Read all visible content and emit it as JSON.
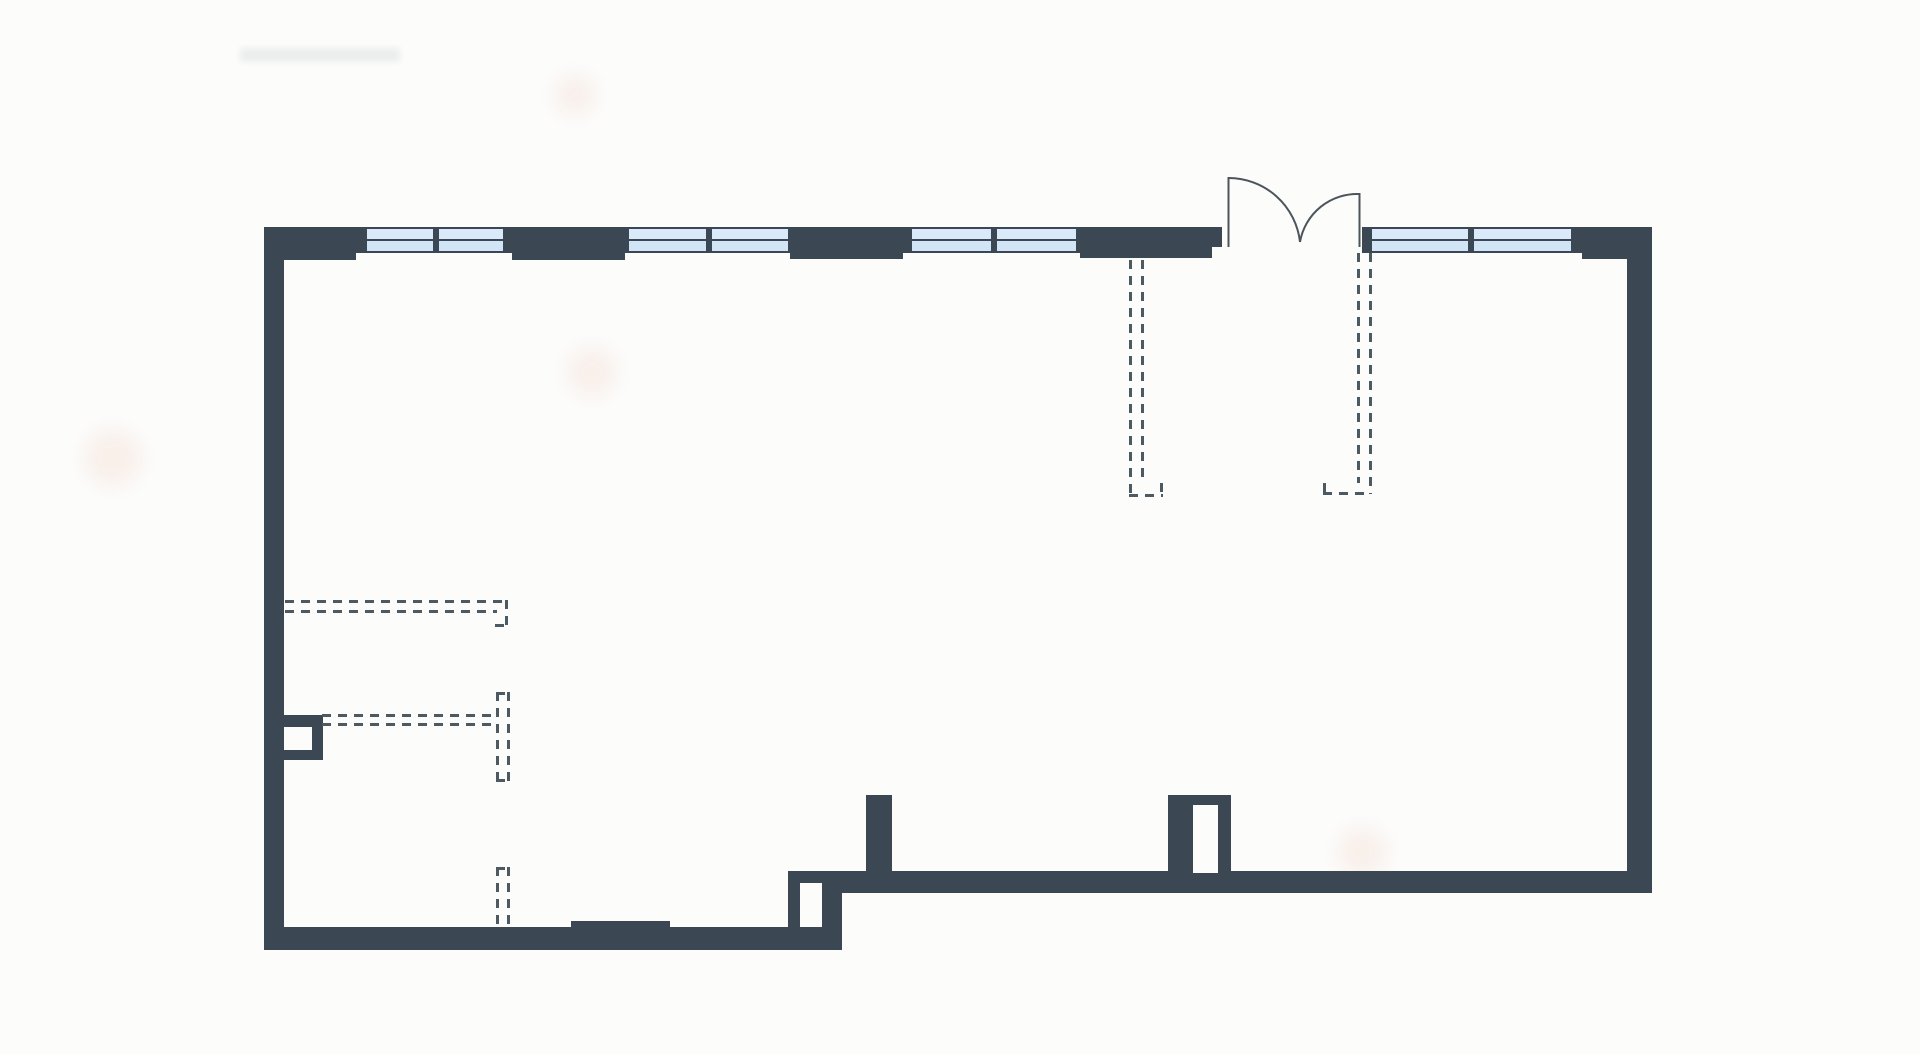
{
  "app": {
    "type": "architectural-floor-plan",
    "canvas": {
      "width": 1920,
      "height": 1054
    }
  },
  "colors": {
    "background": "#fcfcfb",
    "wall": "#3b4853",
    "dash": "#4e5a62",
    "window_pane_top": "#dbeafa",
    "window_pane_bottom": "#d2e5f6",
    "door_line": "#4d545b",
    "blob": "rgba(246,230,220,0.55)",
    "smudge": "#9aa0a4"
  },
  "plan": {
    "walls": [
      {
        "name": "top-corner-block-left",
        "x": 264,
        "y": 227,
        "w": 92,
        "h": 33
      },
      {
        "name": "top-wall-band-left-of-door",
        "x": 356,
        "y": 227,
        "w": 856,
        "h": 26
      },
      {
        "name": "top-wall-band-right-of-door",
        "x": 1362,
        "y": 227,
        "w": 290,
        "h": 26
      },
      {
        "name": "top-wall-block-b",
        "x": 512,
        "y": 227,
        "w": 113,
        "h": 33
      },
      {
        "name": "top-wall-block-c",
        "x": 790,
        "y": 227,
        "w": 113,
        "h": 32
      },
      {
        "name": "top-wall-block-d",
        "x": 1080,
        "y": 227,
        "w": 132,
        "h": 31
      },
      {
        "name": "door-jamb-left",
        "x": 1212,
        "y": 227,
        "w": 10,
        "h": 20
      },
      {
        "name": "door-jamb-right",
        "x": 1362,
        "y": 227,
        "w": 10,
        "h": 23
      },
      {
        "name": "top-corner-block-right",
        "x": 1573,
        "y": 227,
        "w": 79,
        "h": 25
      },
      {
        "name": "top-corner-right-ledge",
        "x": 1582,
        "y": 252,
        "w": 45,
        "h": 7
      },
      {
        "name": "left-wall",
        "x": 264,
        "y": 227,
        "w": 20,
        "h": 723
      },
      {
        "name": "right-wall",
        "x": 1627,
        "y": 227,
        "w": 25,
        "h": 666
      },
      {
        "name": "bottom-wall-lower",
        "x": 264,
        "y": 927,
        "w": 578,
        "h": 23
      },
      {
        "name": "bottom-wall-upper",
        "x": 788,
        "y": 871,
        "w": 864,
        "h": 22
      },
      {
        "name": "bottom-wall-step-connector",
        "x": 788,
        "y": 871,
        "w": 54,
        "h": 79
      },
      {
        "name": "bottom-wall-sill-strip",
        "x": 571,
        "y": 921,
        "w": 99,
        "h": 7
      },
      {
        "name": "interior-wall-stub",
        "x": 866,
        "y": 795,
        "w": 26,
        "h": 78
      },
      {
        "name": "interior-doorframe-stub",
        "x": 1168,
        "y": 795,
        "w": 63,
        "h": 78
      },
      {
        "name": "left-wall-column-box",
        "x": 284,
        "y": 715,
        "w": 39,
        "h": 45
      }
    ],
    "openings": [
      {
        "name": "step-wall-door-opening",
        "x": 800,
        "y": 883,
        "w": 22,
        "h": 44
      },
      {
        "name": "doorframe-stub-opening",
        "x": 1193,
        "y": 805,
        "w": 25,
        "h": 68
      },
      {
        "name": "column-box-opening",
        "x": 284,
        "y": 727,
        "w": 28,
        "h": 23
      }
    ],
    "windows": [
      {
        "name": "window-a1",
        "x": 365,
        "y": 227,
        "w": 70,
        "h": 26
      },
      {
        "name": "window-a2",
        "x": 437,
        "y": 227,
        "w": 68,
        "h": 26
      },
      {
        "name": "window-b1",
        "x": 627,
        "y": 227,
        "w": 81,
        "h": 26
      },
      {
        "name": "window-b2",
        "x": 710,
        "y": 227,
        "w": 80,
        "h": 26
      },
      {
        "name": "window-c1",
        "x": 910,
        "y": 227,
        "w": 83,
        "h": 26
      },
      {
        "name": "window-c2",
        "x": 995,
        "y": 227,
        "w": 83,
        "h": 26
      },
      {
        "name": "window-d1",
        "x": 1370,
        "y": 227,
        "w": 100,
        "h": 26
      },
      {
        "name": "window-d2",
        "x": 1472,
        "y": 227,
        "w": 101,
        "h": 26
      }
    ],
    "partition_dashes": [
      {
        "name": "closet-dash-left-a",
        "dir": "v",
        "x": 1129,
        "y": 260,
        "len": 237
      },
      {
        "name": "closet-dash-left-b",
        "dir": "v",
        "x": 1141,
        "y": 260,
        "len": 223
      },
      {
        "name": "closet-dash-left-foot",
        "dir": "h",
        "x": 1129,
        "y": 494,
        "len": 34
      },
      {
        "name": "closet-dash-left-tick",
        "dir": "v",
        "x": 1160,
        "y": 483,
        "len": 12
      },
      {
        "name": "closet-dash-right-a",
        "dir": "v",
        "x": 1357,
        "y": 253,
        "len": 230
      },
      {
        "name": "closet-dash-right-b",
        "dir": "v",
        "x": 1369,
        "y": 253,
        "len": 241
      },
      {
        "name": "closet-dash-right-foot",
        "dir": "h",
        "x": 1323,
        "y": 492,
        "len": 47
      },
      {
        "name": "closet-dash-right-tick",
        "dir": "v",
        "x": 1323,
        "y": 483,
        "len": 10
      },
      {
        "name": "partition-dash-h1-a",
        "dir": "h",
        "x": 285,
        "y": 600,
        "len": 223
      },
      {
        "name": "partition-dash-h1-b",
        "dir": "h",
        "x": 285,
        "y": 610,
        "len": 212
      },
      {
        "name": "partition-dash-h1-elbow",
        "dir": "v",
        "x": 505,
        "y": 600,
        "len": 27
      },
      {
        "name": "partition-dash-h1-tick",
        "dir": "h",
        "x": 495,
        "y": 624,
        "len": 11
      },
      {
        "name": "partition-dash-h2-a",
        "dir": "h",
        "x": 322,
        "y": 714,
        "len": 175
      },
      {
        "name": "partition-dash-h2-b",
        "dir": "h",
        "x": 322,
        "y": 723,
        "len": 175
      },
      {
        "name": "partition-dash-v1-a",
        "dir": "v",
        "x": 496,
        "y": 692,
        "len": 90
      },
      {
        "name": "partition-dash-v1-b",
        "dir": "v",
        "x": 507,
        "y": 692,
        "len": 90
      },
      {
        "name": "partition-dash-v1-cap-top",
        "dir": "h",
        "x": 496,
        "y": 692,
        "len": 14
      },
      {
        "name": "partition-dash-v1-cap-bot",
        "dir": "h",
        "x": 496,
        "y": 779,
        "len": 14
      },
      {
        "name": "partition-dash-v2-a",
        "dir": "v",
        "x": 496,
        "y": 867,
        "len": 60
      },
      {
        "name": "partition-dash-v2-b",
        "dir": "v",
        "x": 507,
        "y": 867,
        "len": 60
      },
      {
        "name": "partition-dash-v2-cap",
        "dir": "h",
        "x": 496,
        "y": 867,
        "len": 14
      }
    ],
    "door": {
      "paths": [
        {
          "name": "door-leaf-left-line",
          "d": "M 1228.5 177 L 1228.5 247"
        },
        {
          "name": "door-leaf-right-line",
          "d": "M 1359.5 193 L 1359.5 247"
        },
        {
          "name": "door-swing-arc-left",
          "d": "M 1228.5 178 A 72 72 0 0 1 1300 242"
        },
        {
          "name": "door-swing-arc-right",
          "d": "M 1359.5 194 A 58 58 0 0 0 1300 242"
        }
      ]
    },
    "artifacts": {
      "blobs": [
        {
          "name": "paper-blemish-1",
          "x": 575,
          "y": 95,
          "r": 20
        },
        {
          "name": "paper-blemish-2",
          "x": 592,
          "y": 372,
          "r": 24
        },
        {
          "name": "paper-blemish-3",
          "x": 113,
          "y": 458,
          "r": 28
        },
        {
          "name": "paper-blemish-4",
          "x": 1362,
          "y": 852,
          "r": 24
        }
      ],
      "smudge": {
        "name": "faint-pencil-smudge",
        "x": 240,
        "y": 48,
        "w": 160,
        "h": 14
      }
    }
  }
}
